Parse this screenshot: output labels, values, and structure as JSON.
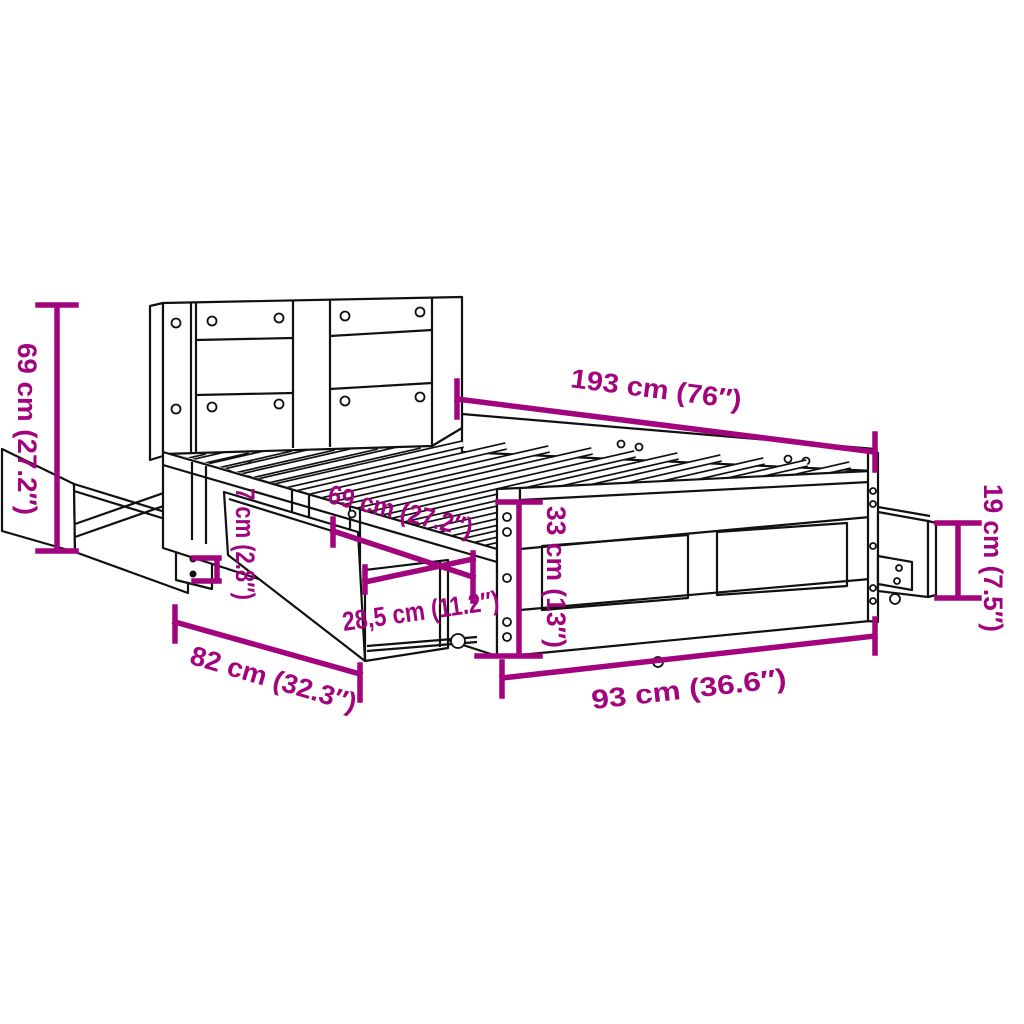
{
  "diagram": {
    "type": "furniture-dimension-diagram",
    "subject": "bed frame with headboard and pull-out storage drawers",
    "background_color": "#FFFFFF",
    "line_color": "#111111",
    "dimension_color": "#A1047D",
    "dimensions": [
      {
        "id": "headboard-height",
        "cm": "69",
        "inches": "27.2",
        "label": "69 cm (27.2″)"
      },
      {
        "id": "bed-length",
        "cm": "193",
        "inches": "76",
        "label": "193 cm (76″)"
      },
      {
        "id": "side-drawer-height",
        "cm": "19",
        "inches": "7.5",
        "label": "19 cm (7.5″)"
      },
      {
        "id": "under-frame-clearance",
        "cm": "7",
        "inches": "2.8",
        "label": "7 cm (2.8″)"
      },
      {
        "id": "drawer-opening-width",
        "cm": "69",
        "inches": "27.2",
        "label": "69 cm (27.2″)"
      },
      {
        "id": "drawer-depth",
        "cm": "28,5",
        "inches": "11.2",
        "label": "28,5 cm (11.2″)"
      },
      {
        "id": "frame-height",
        "cm": "33",
        "inches": "13",
        "label": "33 cm (13″)"
      },
      {
        "id": "front-drawer-width",
        "cm": "82",
        "inches": "32.3",
        "label": "82 cm (32.3″)"
      },
      {
        "id": "bed-width",
        "cm": "93",
        "inches": "36.6",
        "label": "93 cm (36.6″)"
      }
    ]
  }
}
